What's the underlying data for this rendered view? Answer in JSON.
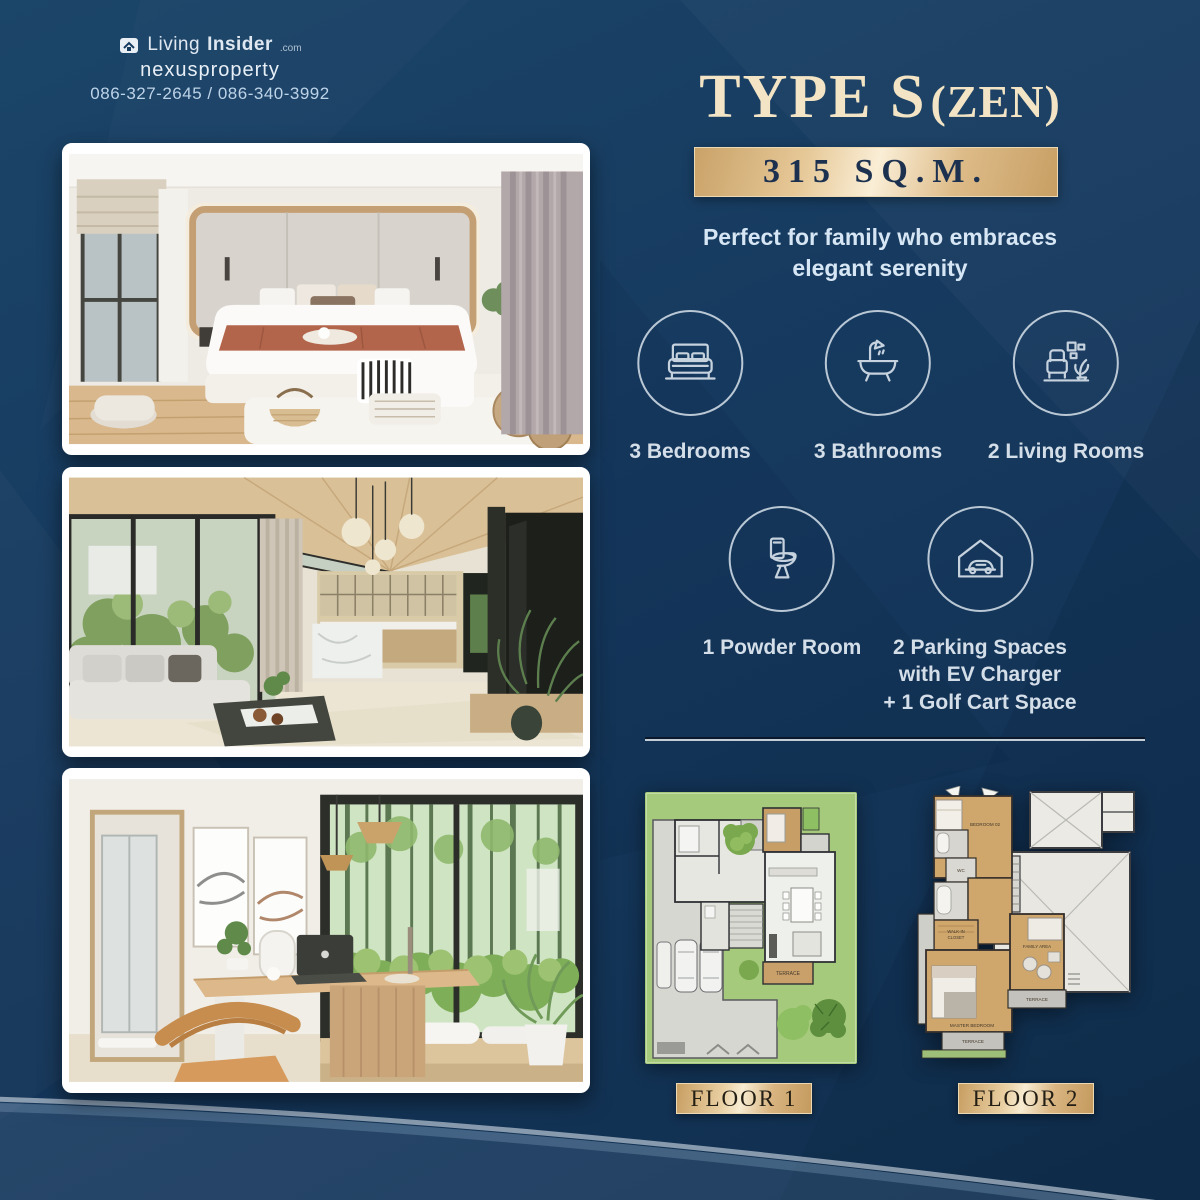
{
  "colors": {
    "navy": "#16395e",
    "gold": "#d9b583",
    "cream": "#f2e4c4",
    "icon_line": "#c6d2de"
  },
  "header": {
    "brand_prefix": "Living",
    "brand_suffix": "Insider",
    "brand_tld": ".com",
    "agency": "nexusproperty",
    "phones": "086-327-2645 / 086-340-3992"
  },
  "hero": {
    "title_main": "TYPE S",
    "title_sub": "(ZEN)",
    "area": "315 SQ.M.",
    "tagline1": "Perfect for family who embraces",
    "tagline2": "elegant serenity"
  },
  "features": {
    "bedrooms": "3 Bedrooms",
    "bathrooms": "3 Bathrooms",
    "living_rooms": "2 Living Rooms",
    "powder": "1 Powder Room",
    "parking1": "2 Parking Spaces",
    "parking2": "with EV Charger",
    "parking3": "+ 1 Golf Cart Space"
  },
  "floorplans": {
    "floor1_label": "FLOOR 1",
    "floor2_label": "FLOOR 2",
    "floor1_rooms": {
      "terrace": "TERRACE"
    },
    "floor2_rooms": {
      "bedroom2": "BEDROOM 02",
      "wc": "WC",
      "walkin_line1": "WALK-IN",
      "walkin_line2": "CLOSET",
      "master": "MASTER BEDROOM",
      "family": "FAMILY AREA",
      "terrace_rear": "TERRACE",
      "terrace_front": "TERRACE"
    }
  },
  "photos": [
    {
      "alt": "Bedroom with wood-framed headboard"
    },
    {
      "alt": "Double-height living room and kitchen"
    },
    {
      "alt": "Home office desk with forest view"
    }
  ]
}
